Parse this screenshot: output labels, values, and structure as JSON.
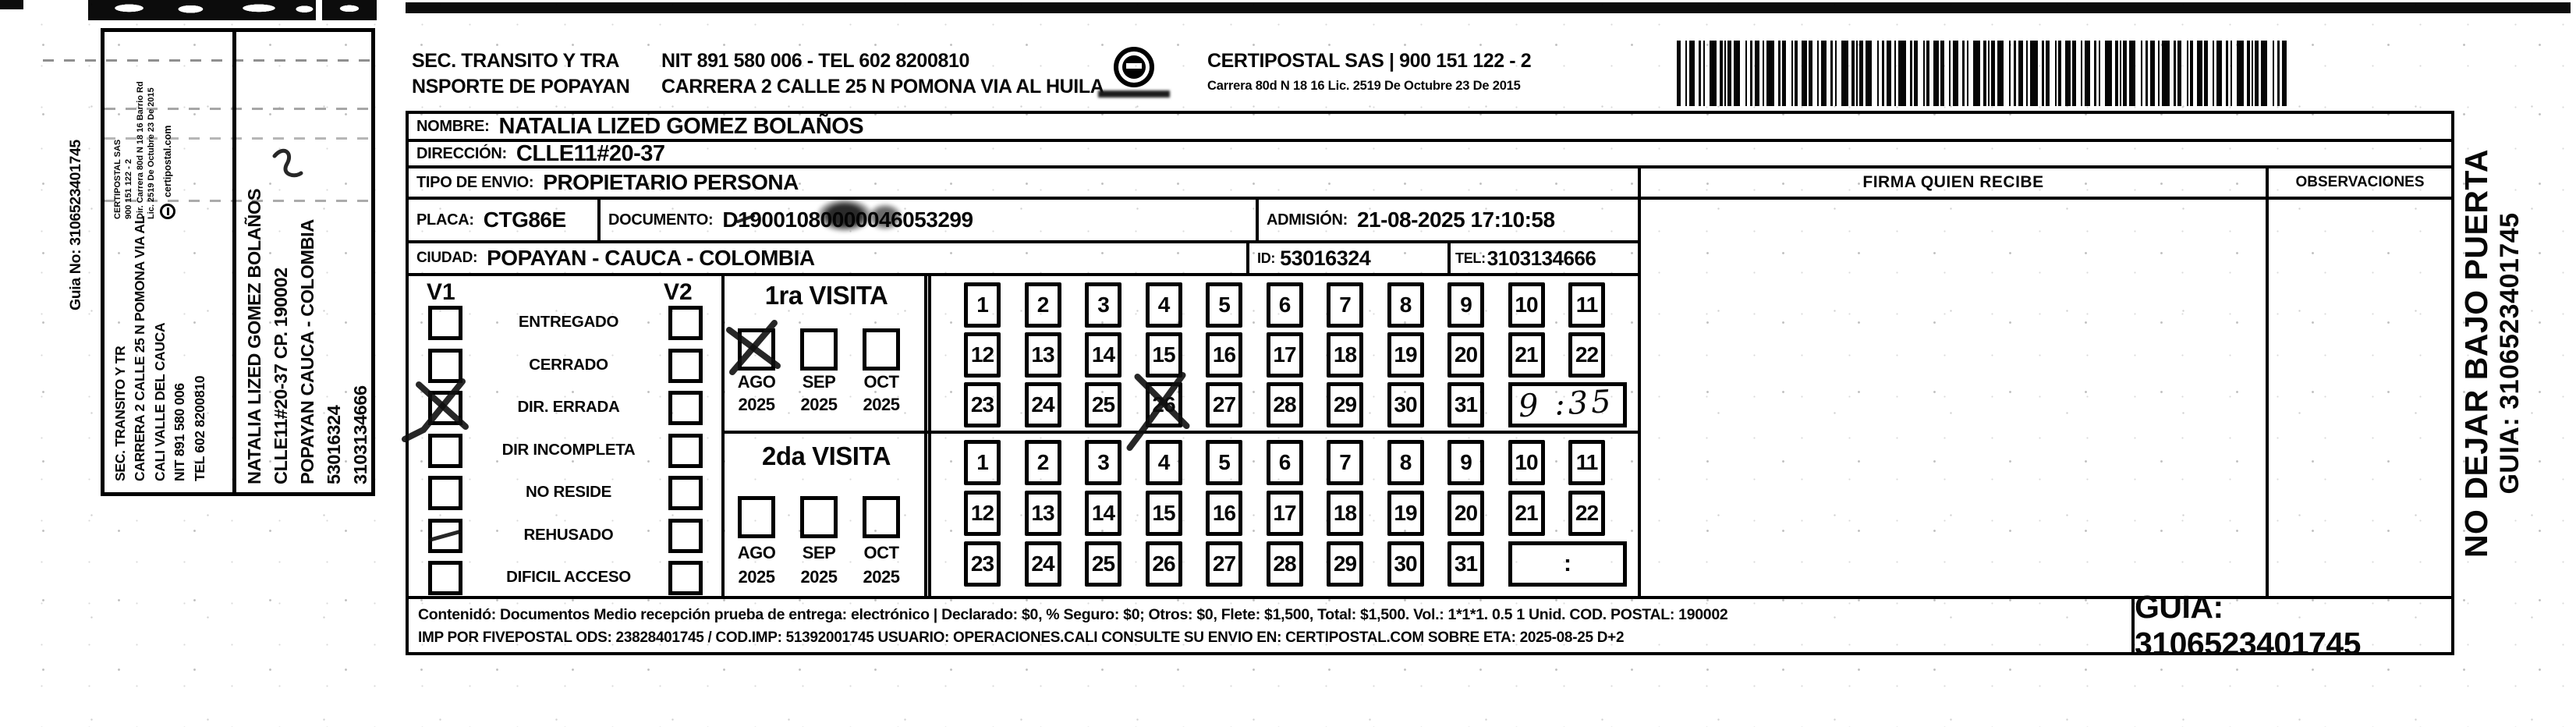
{
  "rail": {
    "guia_no": "Guia No: 3106523401745",
    "sender": {
      "lines": [
        "SEC. TRANSITO Y TR",
        "CARRERA 2 CALLE 25 N POMONA VIA AL",
        "CALI VALLE DEL CAUCA",
        "NIT 891 580 006",
        "TEL 602 8200810"
      ],
      "cert_lines": [
        "CERTIPOSTAL SAS",
        "900 151 122 - 2",
        "Dir. Carrera 80d N 18 16 Barrio Rd",
        "Lic. 2519 De Octubre 23 De 2015"
      ],
      "cert_web": "certipostal.com"
    },
    "recipient": {
      "lines": [
        "NATALIA LIZED GOMEZ BOLAÑOS",
        "CLLE11#20-37 CP. 190002",
        "POPAYAN CAUCA - COLOMBIA",
        "53016324",
        "3103134666"
      ]
    }
  },
  "header": {
    "entity_line1": "SEC. TRANSITO Y TRA",
    "entity_line2": "NSPORTE DE POPAYAN",
    "nit_tel": "NIT 891 580 006 - TEL 602 8200810",
    "address": "CARRERA 2 CALLE 25 N POMONA VIA AL HUILA",
    "cert_name": "CERTIPOSTAL SAS | 900 151 122 - 2",
    "cert_addr": "Carrera 80d N 18 16  Lic. 2519 De Octubre 23 De 2015"
  },
  "form": {
    "nombre_label": "NOMBRE:",
    "nombre_value": "NATALIA LIZED GOMEZ BOLAÑOS",
    "direccion_label": "DIRECCIÓN:",
    "direccion_value": "CLLE11#20-37",
    "tipo_label": "TIPO DE ENVIO:",
    "tipo_value": "PROPIETARIO PERSONA",
    "placa_label": "PLACA:",
    "placa_value": "CTG86E",
    "documento_label": "DOCUMENTO:",
    "documento_value": "D19001080000046053299",
    "admision_label": "ADMISIÓN:",
    "admision_value": "21-08-2025 17:10:58",
    "ciudad_label": "CIUDAD:",
    "ciudad_value": "POPAYAN - CAUCA - COLOMBIA",
    "id_label": "ID:",
    "id_value": "53016324",
    "tel_label": "TEL:",
    "tel_value": "3103134666",
    "firma_header": "FIRMA QUIEN RECIBE",
    "observaciones_header": "OBSERVACIONES"
  },
  "status_panel": {
    "v1_label": "V1",
    "v2_label": "V2",
    "options": [
      "ENTREGADO",
      "CERRADO",
      "DIR. ERRADA",
      "DIR INCOMPLETA",
      "NO RESIDE",
      "REHUSADO",
      "DIFICIL ACCESO"
    ],
    "v1_checked": "DIR. ERRADA"
  },
  "visits": {
    "first": {
      "title": "1ra VISITA",
      "months": [
        "AGO",
        "SEP",
        "OCT"
      ],
      "year": "2025",
      "checked_month": "AGO",
      "days": [
        1,
        2,
        3,
        4,
        5,
        6,
        7,
        8,
        9,
        10,
        11,
        12,
        13,
        14,
        15,
        16,
        17,
        18,
        19,
        20,
        21,
        22,
        23,
        24,
        25,
        26,
        27,
        28,
        29,
        30,
        31
      ],
      "crossed_day": 26,
      "time_value": "9 :35"
    },
    "second": {
      "title": "2da VISITA",
      "months": [
        "AGO",
        "SEP",
        "OCT"
      ],
      "year": "2025",
      "checked_month": "",
      "days": [
        1,
        2,
        3,
        4,
        5,
        6,
        7,
        8,
        9,
        10,
        11,
        12,
        13,
        14,
        15,
        16,
        17,
        18,
        19,
        20,
        21,
        22,
        23,
        24,
        25,
        26,
        27,
        28,
        29,
        30,
        31
      ],
      "time_value": ":"
    }
  },
  "footer": {
    "line1": "Contenidó: Documentos Medio recepción prueba de entrega: electrónico | Declarado: $0, % Seguro: $0; Otros: $0, Flete: $1,500, Total: $1,500. Vol.: 1*1*1. 0.5  1 Unid. COD. POSTAL: 190002",
    "line2": "IMP POR FIVEPOSTAL ODS: 23828401745 / COD.IMP: 51392001745 USUARIO: OPERACIONES.CALI CONSULTE SU ENVIO EN: CERTIPOSTAL.COM SOBRE ETA: 2025-08-25 D+2",
    "guia_label": "GUIA: 3106523401745"
  },
  "side_note": {
    "line1": "NO DEJAR BAJO PUERTA",
    "line2": "GUIA: 3106523401745"
  }
}
